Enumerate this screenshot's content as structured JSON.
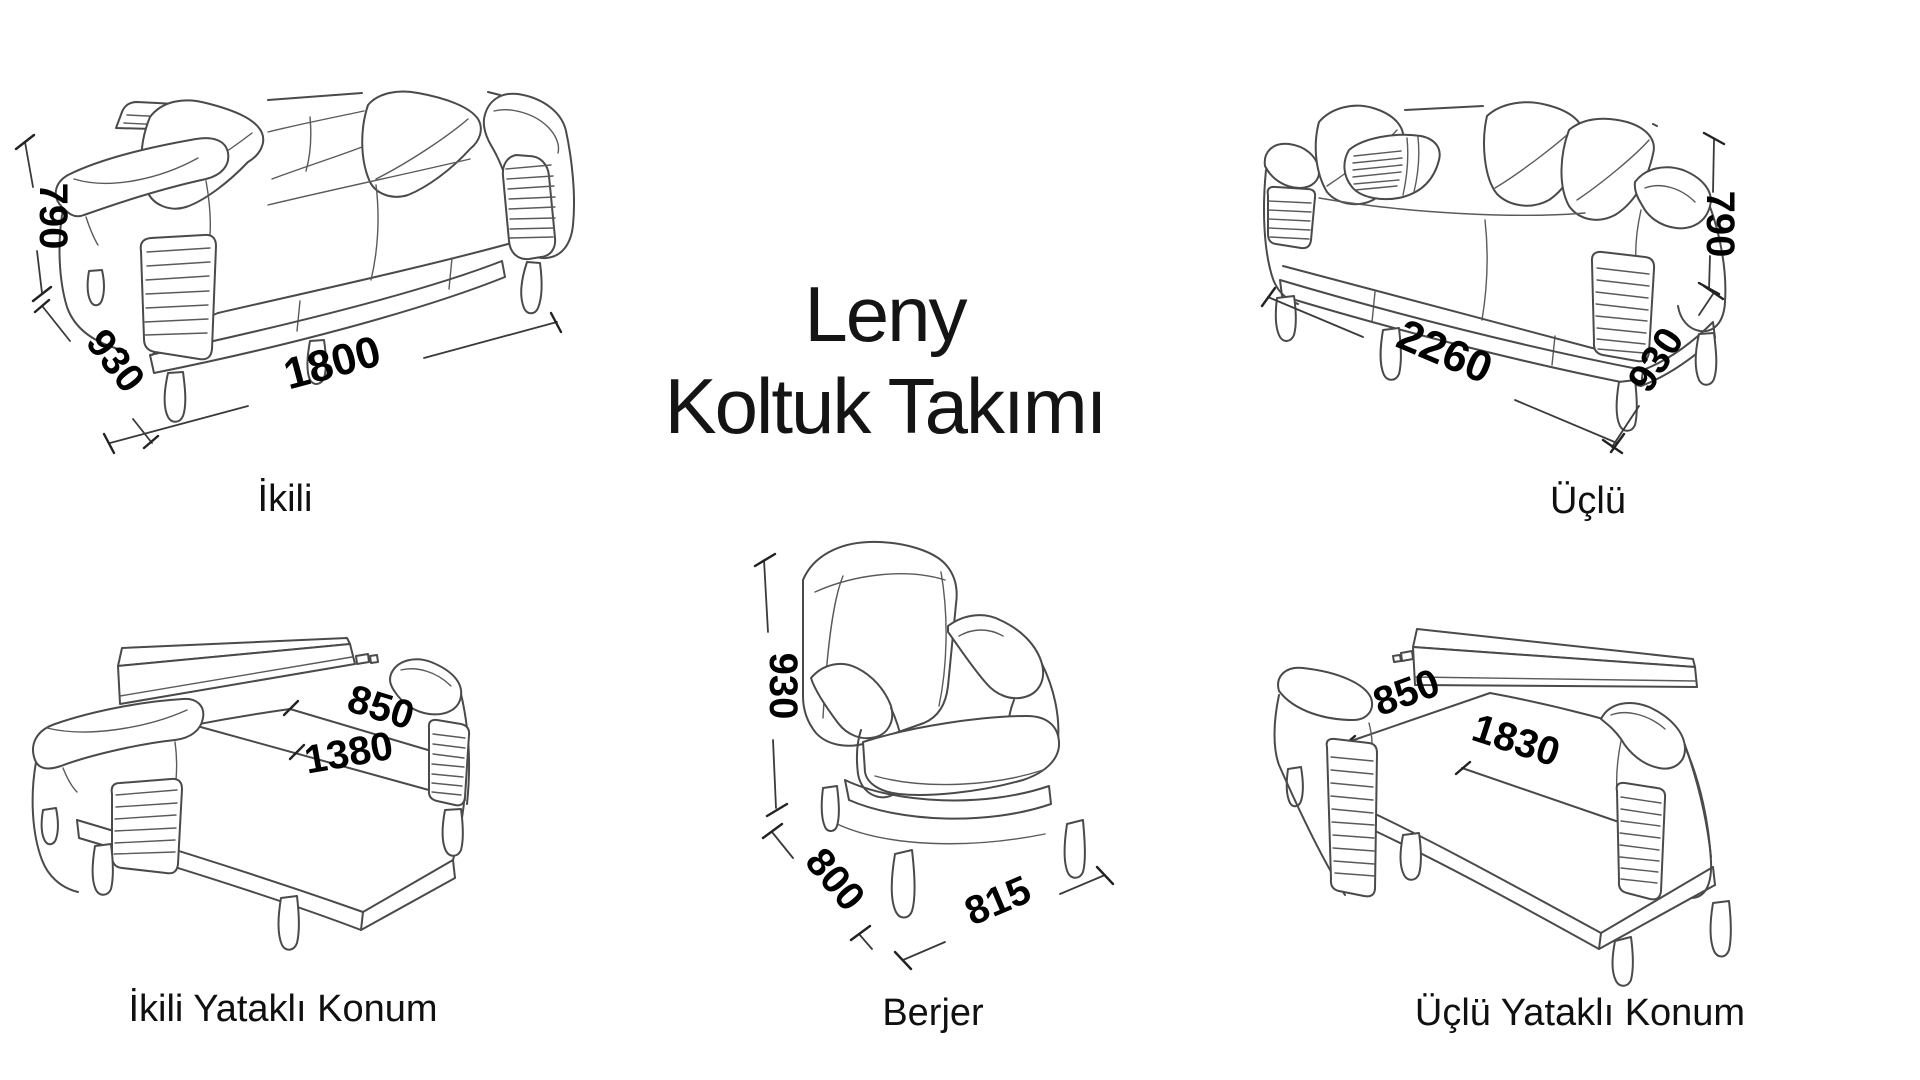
{
  "title": {
    "line1": "Leny",
    "line2": "Koltuk Takımı"
  },
  "products": [
    {
      "label": "İkili",
      "dims": {
        "height": "790",
        "depth": "930",
        "width": "1800"
      }
    },
    {
      "label": "Üçlü",
      "dims": {
        "height": "790",
        "depth": "930",
        "width": "2260"
      }
    },
    {
      "label": "İkili Yataklı Konum",
      "dims": {
        "bed_depth": "850",
        "bed_length": "1380"
      }
    },
    {
      "label": "Berjer",
      "dims": {
        "height": "930",
        "depth": "800",
        "width": "815"
      }
    },
    {
      "label": "Üçlü Yataklı Konum",
      "dims": {
        "bed_depth": "850",
        "bed_length": "1830"
      }
    }
  ],
  "colors": {
    "background": "#ffffff",
    "line_art": "#4a4a4a",
    "dimension_text": "#000000",
    "label_text": "#101010",
    "title_text": "#141414"
  }
}
